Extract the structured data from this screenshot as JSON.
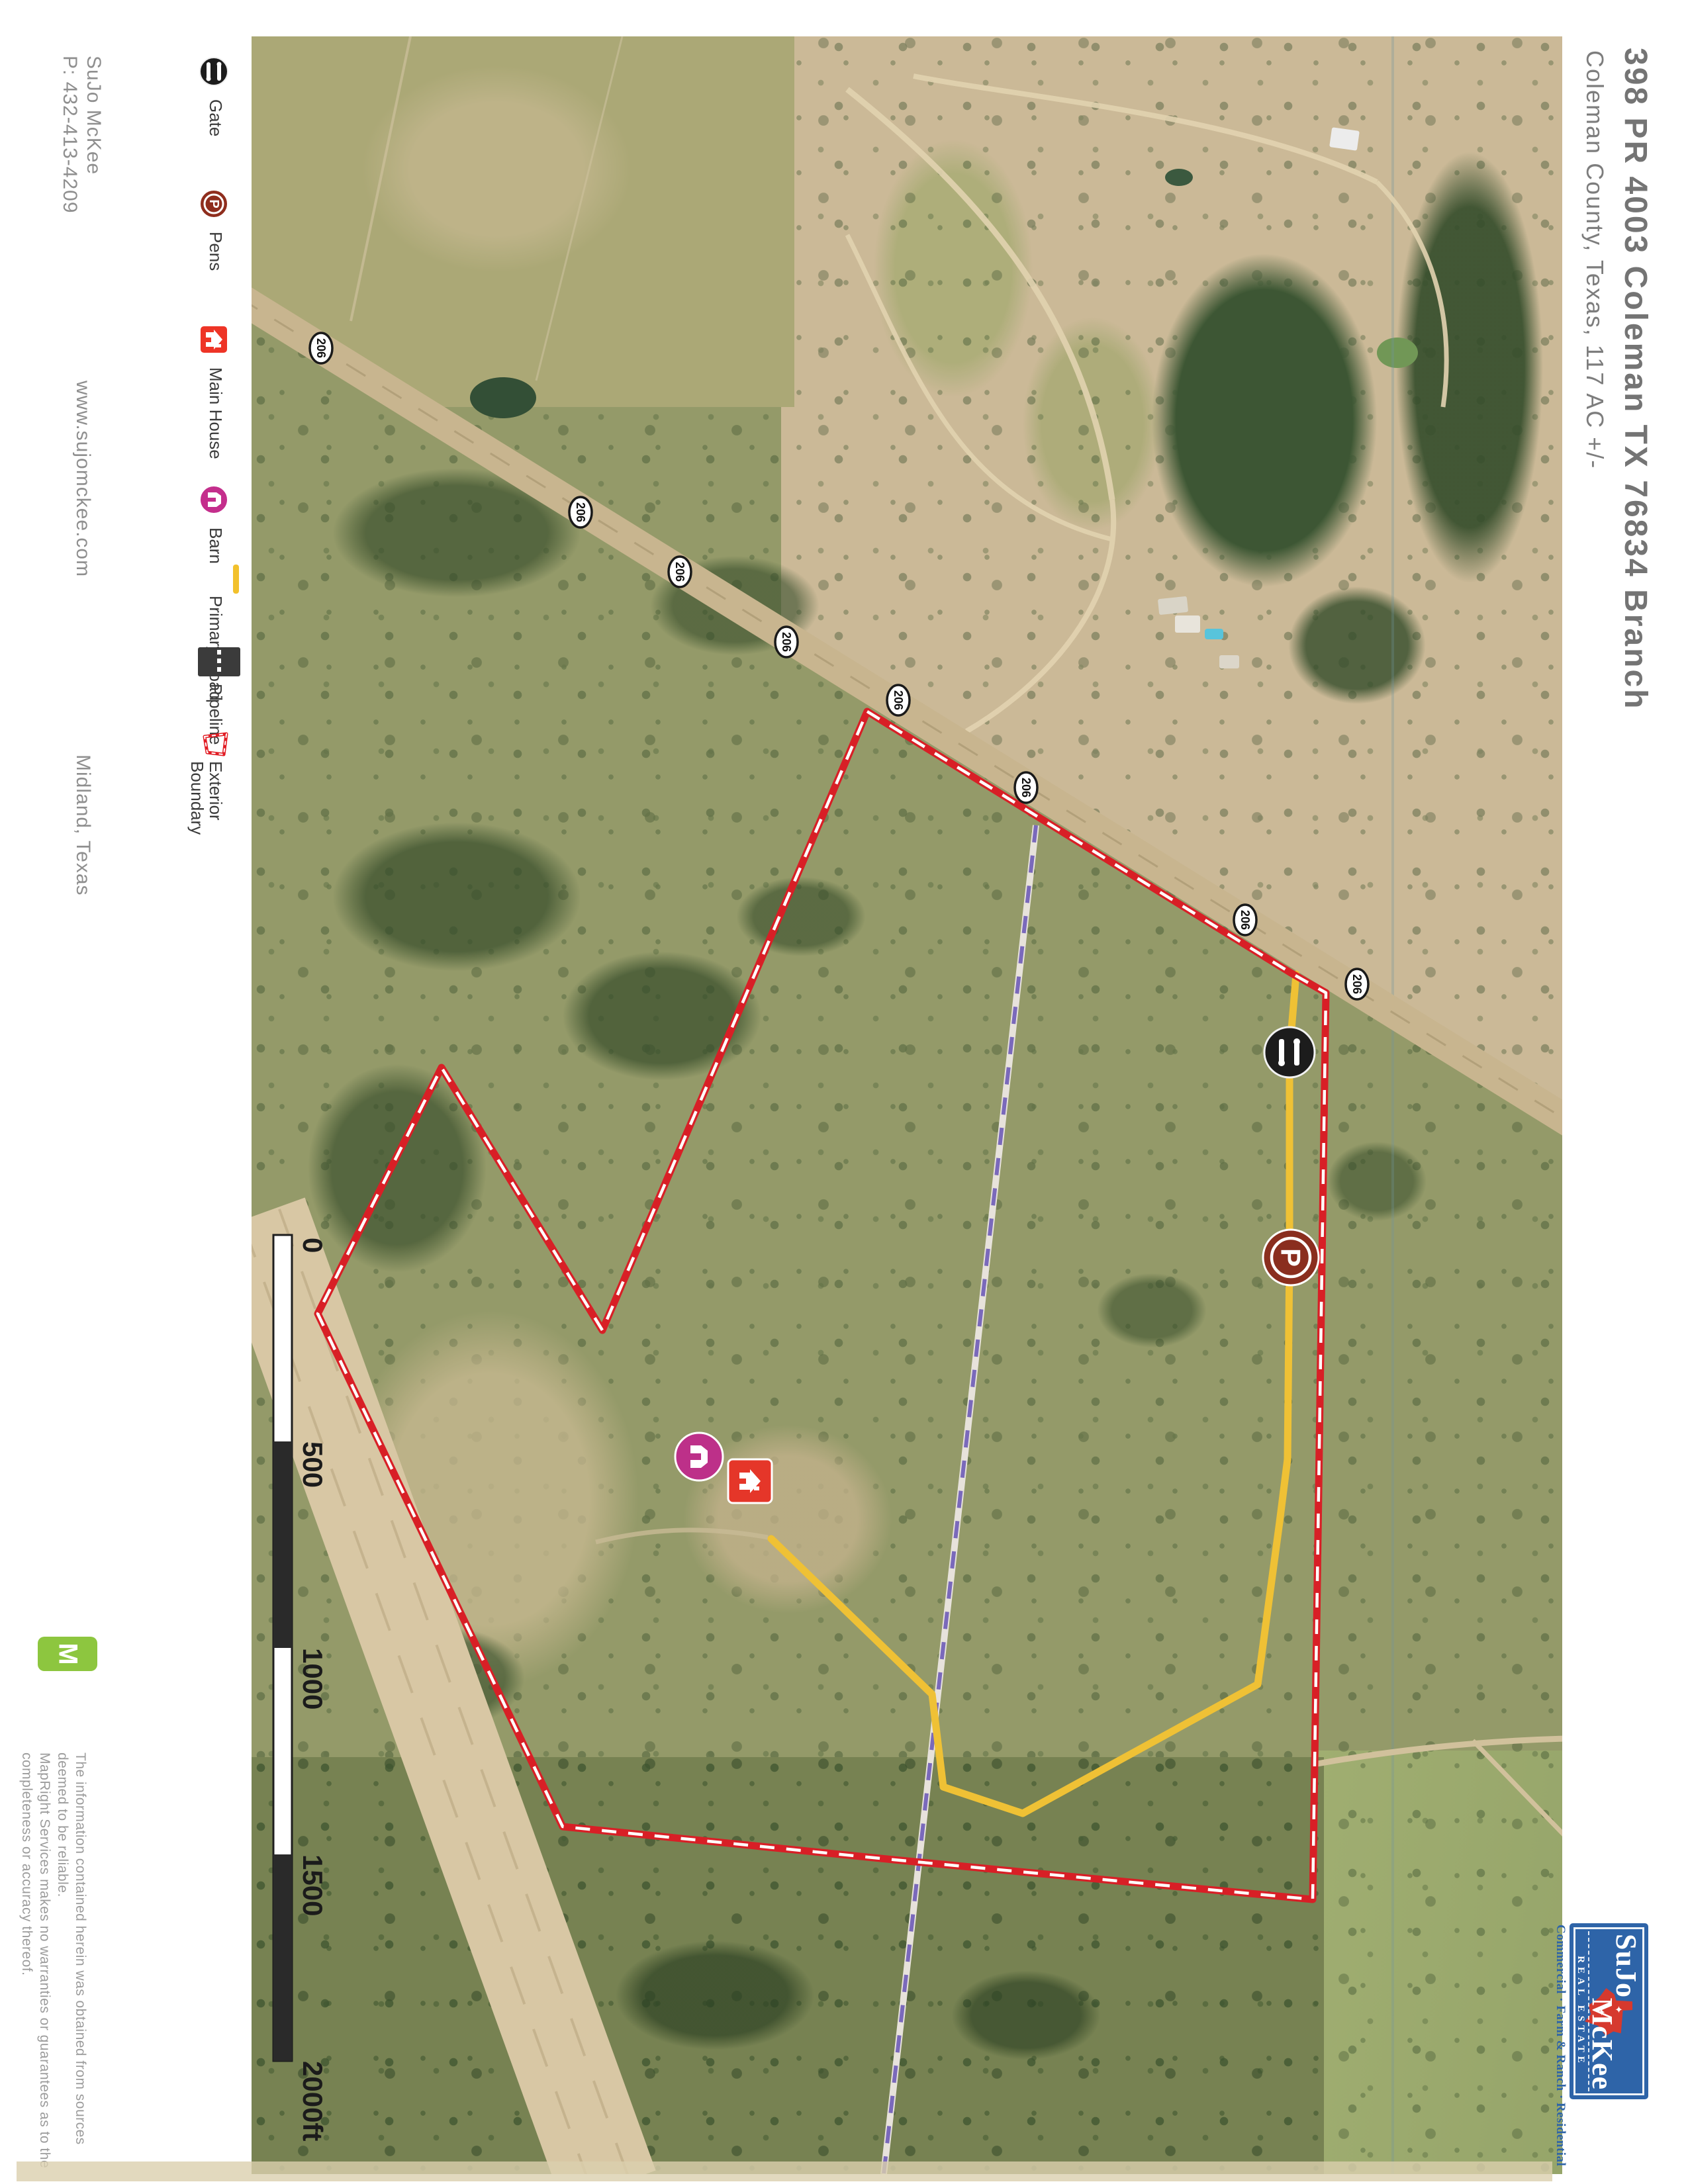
{
  "title": {
    "address": "398 PR 4003 Coleman TX 76834 Branch",
    "county_acreage": "Coleman County, Texas, 117 AC +/-"
  },
  "agent": {
    "name": "SuJo McKee",
    "phone": "P: 432-413-4209",
    "website": "www.sujomckee.com",
    "city": "Midland, Texas"
  },
  "legend": {
    "gate": "Gate",
    "pens": "Pens",
    "main_house": "Main House",
    "barn": "Barn",
    "primary_road": "Primary Road",
    "pipeline": "Pipeline",
    "exterior_boundary_line1": "Exterior",
    "exterior_boundary_line2": "Boundary"
  },
  "map": {
    "road_shield_label": "206",
    "pens_marker_letter": "P",
    "scale_labels": {
      "l0": "0",
      "l1": "500",
      "l2": "1000",
      "l3": "1500",
      "l4": "2000ft"
    }
  },
  "branding": {
    "mapright_letter": "M",
    "sujo_word1": "SuJo",
    "sujo_word2": "McKee",
    "sujo_banner_letters": "REAL ESTATE",
    "sujo_tagline": "Commercial · Farm & Ranch · Residential"
  },
  "disclaimer": {
    "line1": "The information contained herein was obtained from sources",
    "line2": "deemed to be reliable.",
    "line3": "MapRight Services makes no warranties or guarantees as to the",
    "line4": "completeness or accuracy thereof."
  },
  "colors": {
    "boundary_red": "#e11c24",
    "primary_road_yellow": "#f2c12c",
    "pipeline_purple": "#7a68c0",
    "gate_black": "#1c1c1c",
    "pens_maroon": "#8f2d1d",
    "main_house_red": "#ee3426",
    "barn_magenta": "#c42e8c",
    "mapright_green": "#8dc63f",
    "sujo_blue": "#2e64a8"
  }
}
